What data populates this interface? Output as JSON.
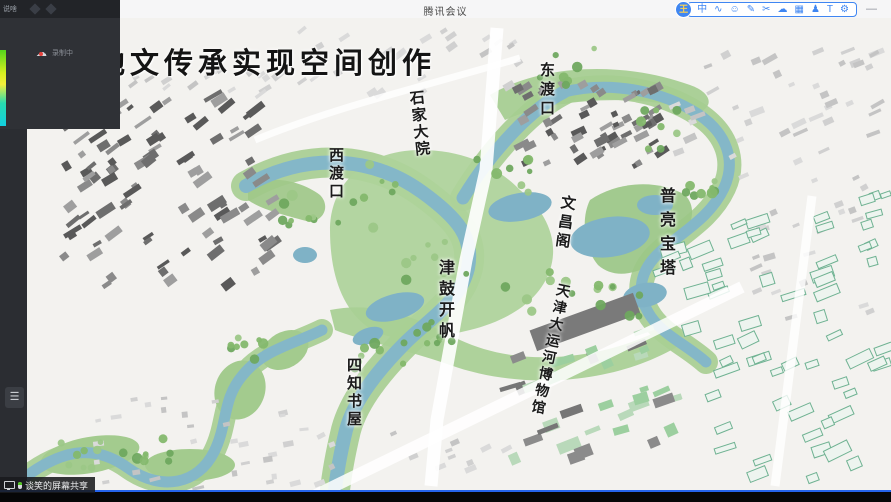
{
  "top_bar": {
    "window_title": "腾讯会议",
    "minimize_glyph": "—"
  },
  "ime_toolbar": {
    "logo_text": "王",
    "icons": [
      {
        "name": "ime-mode-icon",
        "glyph": "中"
      },
      {
        "name": "voice-icon",
        "glyph": "∿"
      },
      {
        "name": "emoji-icon",
        "glyph": "☺"
      },
      {
        "name": "pen-icon",
        "glyph": "✎"
      },
      {
        "name": "scissors-icon",
        "glyph": "✂"
      },
      {
        "name": "cloud-icon",
        "glyph": "☁"
      },
      {
        "name": "keyboard-icon",
        "glyph": "▦"
      },
      {
        "name": "person-icon",
        "glyph": "♟"
      },
      {
        "name": "skin-icon",
        "glyph": "T"
      },
      {
        "name": "settings-icon",
        "glyph": "⚙"
      }
    ]
  },
  "corner_bar": {
    "text": "说啥"
  },
  "recording": {
    "label": "录制中"
  },
  "sidebar": {
    "list_button_glyph": "☰"
  },
  "share_badge": {
    "text": "谈笑的屏幕共享"
  },
  "map": {
    "title": "以地文传承实现空间创作",
    "labels": [
      {
        "id": "dongdukou",
        "text": "东渡口",
        "x": 536,
        "y": 62,
        "fs": 15,
        "ls": 4,
        "rot": 0
      },
      {
        "id": "shijiadayuan",
        "text": "石家大院",
        "x": 405,
        "y": 90,
        "fs": 15,
        "ls": 2,
        "rot": -6
      },
      {
        "id": "xidukou",
        "text": "西渡口",
        "x": 325,
        "y": 147,
        "fs": 15,
        "ls": 3,
        "rot": 0
      },
      {
        "id": "wenchangge",
        "text": "文昌阁",
        "x": 558,
        "y": 195,
        "fs": 15,
        "ls": 4,
        "rot": 8
      },
      {
        "id": "puliangbaota",
        "text": "普亮宝塔",
        "x": 653,
        "y": 187,
        "fs": 16,
        "ls": 8,
        "rot": 0
      },
      {
        "id": "jingukaifan",
        "text": "津鼓开帆",
        "x": 432,
        "y": 259,
        "fs": 16,
        "ls": 5,
        "rot": 0
      },
      {
        "id": "canal-museum",
        "text": "天津大运河博物馆",
        "x": 553,
        "y": 283,
        "fs": 14,
        "ls": 3,
        "rot": 12
      },
      {
        "id": "sizhishuwu",
        "text": "四知书屋",
        "x": 343,
        "y": 357,
        "fs": 15,
        "ls": 3,
        "rot": 0
      }
    ]
  },
  "colors": {
    "accent": "#3f86f2",
    "rec-red": "#e5413c",
    "mic-green": "#4fc41f",
    "share-blue": "#2563eb",
    "river": "#84b7c8",
    "park": "#a6cd90"
  }
}
